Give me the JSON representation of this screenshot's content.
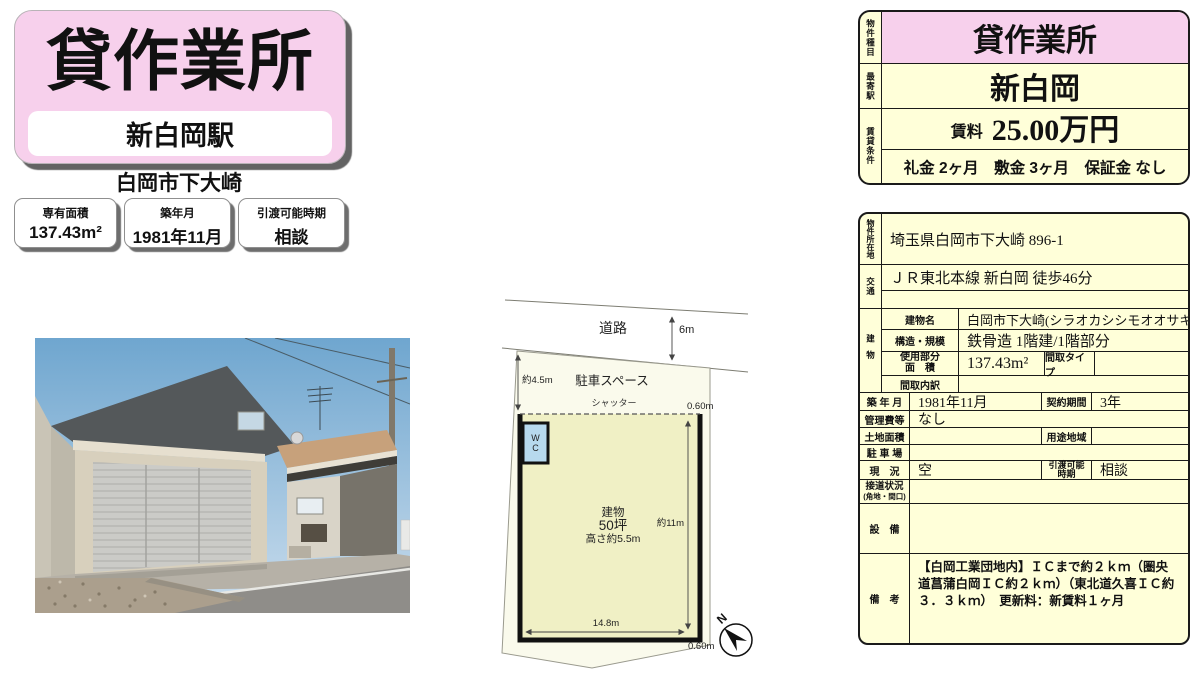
{
  "colors": {
    "pink": "#f7d0ec",
    "cream": "#ffffd9",
    "plan_parcel": "#fafaec",
    "plan_building": "#f0f0c5",
    "wc_blue": "#b7d9ee"
  },
  "header": {
    "title": "貸作業所",
    "station": "新白岡駅",
    "location": "白岡市下大崎"
  },
  "highlights": [
    {
      "label": "専有面積",
      "value": "137.43m²"
    },
    {
      "label": "築年月",
      "value": "1981年11月"
    },
    {
      "label": "引渡可能時期",
      "value": "相談"
    }
  ],
  "summary": {
    "type_label": "物件種目",
    "type_value": "貸作業所",
    "station_label": "最寄駅",
    "station_value": "新白岡",
    "terms_label": "賃貸条件",
    "rent_label": "賃料",
    "rent_value": "25.00万円",
    "fees": "礼金 2ヶ月　敷金 3ヶ月　保証金 なし"
  },
  "details": {
    "address_label": "物件所在地",
    "address": "埼玉県白岡市下大崎 896-1",
    "transport_label": "交通",
    "transport_line1": "ＪＲ東北本線 新白岡 徒歩46分",
    "transport_line2": "",
    "building_label": "建物",
    "building_name_label": "建物名",
    "building_name": "白岡市下大崎(シラオカシシモオオサキ)",
    "structure_label": "構造・規模",
    "structure": "鉄骨造 1階建/1階部分",
    "used_area_label_1": "使用部分",
    "used_area_label_2": "面　積",
    "used_area": "137.43m²",
    "madori_type_label": "間取タイプ",
    "madori_type": "",
    "madori_detail_label": "間取内訳",
    "madori_detail": "",
    "built_label": "築 年 月",
    "built": "1981年11月",
    "contract_label": "契約期間",
    "contract": "3年",
    "mgmt_label": "管理費等",
    "mgmt": "なし",
    "land_label": "土地面積",
    "land": "",
    "zoning_label": "用途地域",
    "zoning": "",
    "parking_label": "駐 車 場",
    "parking": "",
    "status_label": "現　況",
    "status": "空",
    "handover_label_1": "引渡可能",
    "handover_label_2": "時期",
    "handover": "相談",
    "road_label_1": "接道状況",
    "road_label_2": "(角地・間口)",
    "road_value": "",
    "equip_label": "設　備",
    "equip": "",
    "remarks_label": "備　考",
    "remarks": "【白岡工業団地内】ＩＣまで約２ｋｍ（圏央道菖蒲白岡ＩＣ約２ｋｍ）（東北道久喜ＩＣ約３．３ｋｍ）　更新料：新賃料１ヶ月"
  },
  "floor_plan": {
    "road": "道路",
    "road_width": "6m",
    "parking_space": "駐車スペース",
    "parking_depth": "約4.5m",
    "shutter": "シャッター",
    "gap_top": "0.60m",
    "wc_line1": "W",
    "wc_line2": "C",
    "bldg_line1": "建物",
    "bldg_line2": "50坪",
    "bldg_line3": "高さ約5.5m",
    "side_len": "約11m",
    "front_len": "14.8m",
    "gap_bottom": "0.60m",
    "north": "N"
  }
}
